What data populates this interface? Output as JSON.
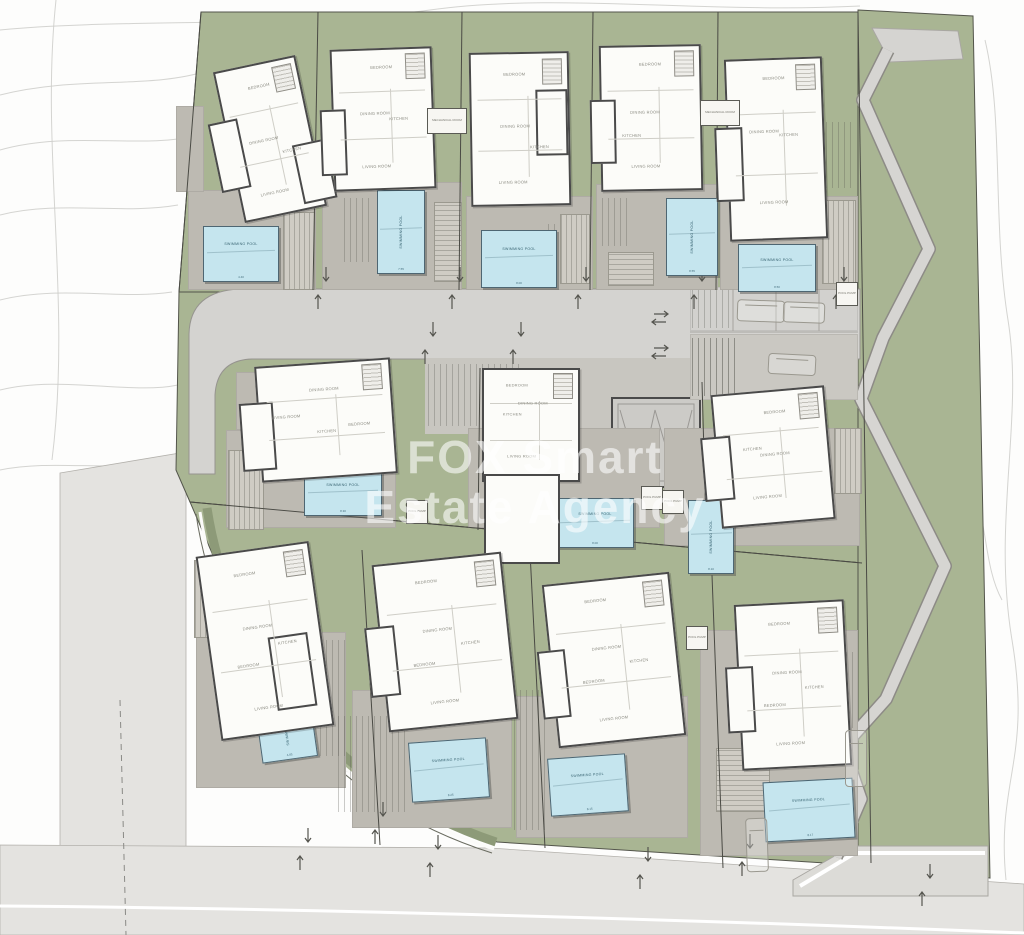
{
  "watermark": {
    "line1": "FOX Smart",
    "line2": "Estate Agency"
  },
  "labels": {
    "swimming_pool": "SWIMMING POOL",
    "pool_pump": "POOL PUMP",
    "mechanical_room": "MECHANICAL ROOM"
  },
  "villas": [
    {
      "id": "villa-1",
      "rooms": [
        "BEDROOM",
        "DINING ROOM",
        "KITCHEN",
        "LIVING ROOM"
      ],
      "pool_label": "SWIMMING POOL",
      "pool_dim": "4.40"
    },
    {
      "id": "villa-2",
      "rooms": [
        "BEDROOM",
        "KITCHEN",
        "DINING ROOM",
        "LIVING ROOM"
      ],
      "pool_label": "SWIMMING POOL",
      "pool_dim": "7.55"
    },
    {
      "id": "villa-3",
      "rooms": [
        "BEDROOM",
        "DINING ROOM",
        "KITCHEN",
        "LIVING ROOM"
      ],
      "pool_label": "SWIMMING POOL",
      "pool_dim": "8.00"
    },
    {
      "id": "villa-4",
      "rooms": [
        "BEDROOM",
        "DINING ROOM",
        "KITCHEN",
        "LIVING ROOM"
      ],
      "pool_label": "SWIMMING POOL",
      "pool_dim": "8.55"
    },
    {
      "id": "villa-5",
      "rooms": [
        "BEDROOM",
        "KITCHEN",
        "DINING ROOM",
        "LIVING ROOM"
      ],
      "pool_label": "SWIMMING POOL",
      "pool_dim": "8.50"
    },
    {
      "id": "villa-6",
      "rooms": [
        "BEDROOM",
        "KITCHEN",
        "DINING ROOM",
        "LIVING ROOM"
      ],
      "pool_label": "SWIMMING POOL",
      "pool_dim": "8.30"
    },
    {
      "id": "villa-7",
      "rooms": [
        "BEDROOM",
        "KITCHEN",
        "DINING ROOM",
        "LIVING ROOM"
      ],
      "pool_label": "SWIMMING POOL",
      "pool_dim": "8.00"
    },
    {
      "id": "villa-8",
      "rooms": [
        "BEDROOM",
        "KITCHEN",
        "DINING ROOM",
        "LIVING ROOM"
      ],
      "pool_label": "SWIMMING POOL",
      "pool_dim": "8.10"
    },
    {
      "id": "villa-9",
      "rooms": [
        "BEDROOM",
        "DINING ROOM",
        "KITCHEN",
        "BEDROOM",
        "LIVING ROOM"
      ],
      "pool_label": "SWIMMING POOL",
      "pool_dim": "4.85"
    },
    {
      "id": "villa-10",
      "rooms": [
        "BEDROOM",
        "DINING ROOM",
        "KITCHEN",
        "BEDROOM",
        "LIVING ROOM"
      ],
      "pool_label": "SWIMMING POOL",
      "pool_dim": "8.25"
    },
    {
      "id": "villa-11",
      "rooms": [
        "BEDROOM",
        "DINING ROOM",
        "KITCHEN",
        "BEDROOM",
        "LIVING ROOM"
      ],
      "pool_label": "SWIMMING POOL",
      "pool_dim": "8.15"
    },
    {
      "id": "villa-12",
      "rooms": [
        "BEDROOM",
        "DINING ROOM",
        "KITCHEN",
        "BEDROOM",
        "LIVING ROOM"
      ],
      "pool_label": "SWIMMING POOL",
      "pool_dim": "8.17"
    }
  ],
  "colors": {
    "lawn": "#a9b593",
    "road": "#d4d3d0",
    "outer_road": "#e4e3e0",
    "paving": "#bdbab2",
    "pool": "#c5e5ee",
    "wall": "#4a4a4a",
    "contour": "#cdccc9",
    "watermark": "rgba(255,255,255,0.58)"
  }
}
